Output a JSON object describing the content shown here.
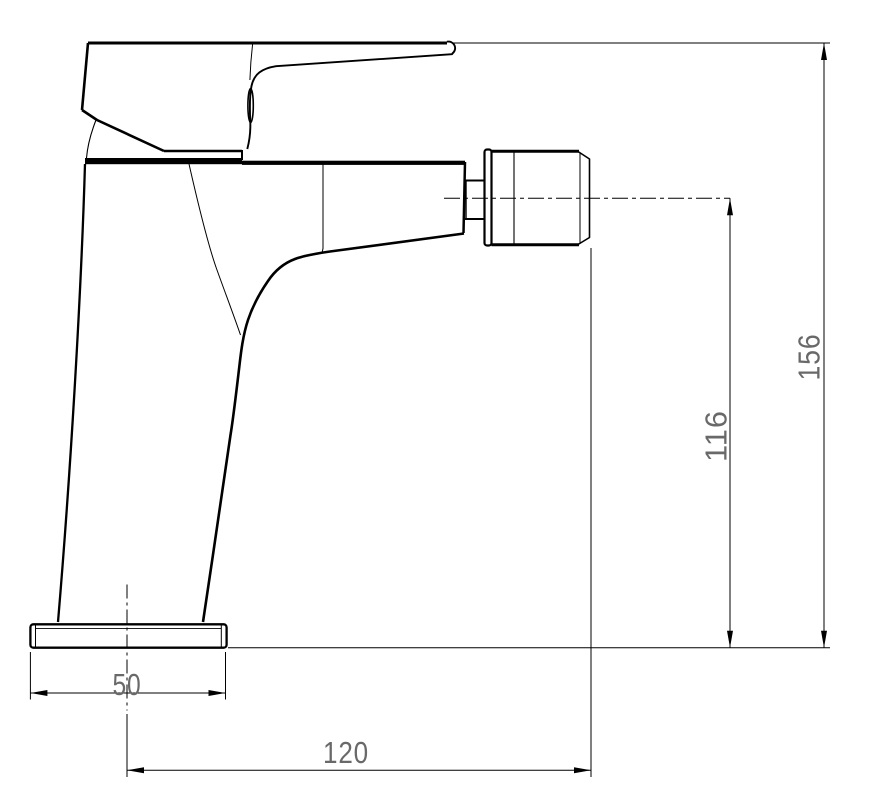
{
  "drawing": {
    "subject": "Single-lever mixer tap, side elevation technical drawing",
    "dimensions": [
      {
        "id": "base-width",
        "label": "50",
        "orientation": "horizontal"
      },
      {
        "id": "spout-reach",
        "label": "120",
        "orientation": "horizontal"
      },
      {
        "id": "spout-height",
        "label": "116",
        "orientation": "vertical"
      },
      {
        "id": "total-height",
        "label": "156",
        "orientation": "vertical"
      }
    ],
    "colors": {
      "line": "#000000",
      "dimension_text": "#696969",
      "background": "#ffffff"
    }
  }
}
